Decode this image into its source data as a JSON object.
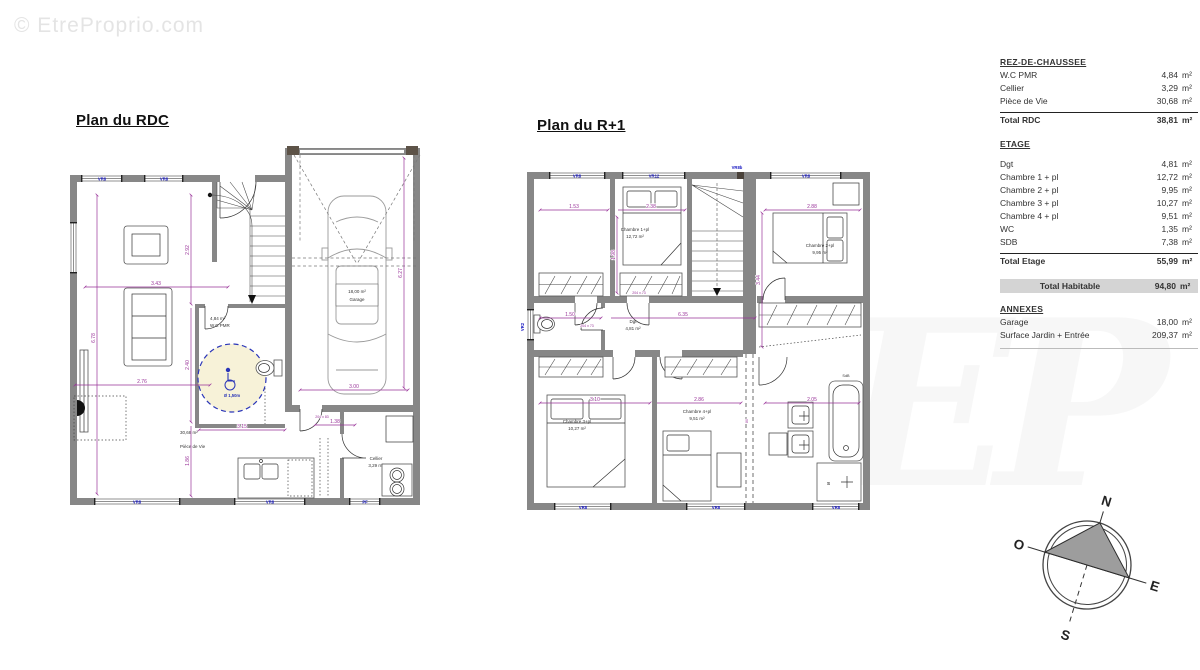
{
  "watermark": {
    "text": "© EtreProprio.com",
    "logo": "EP"
  },
  "plans": {
    "rdc": {
      "title": "Plan du RDC",
      "labels": {
        "wc_area": "4,84 m²",
        "wc_name": "W.C PMR",
        "pmr": "Ø 1,50m",
        "piece_area": "30,68 m²",
        "piece_name": "Pièce de Vie",
        "cellier_name": "Cellier",
        "cellier_area": "3,29 m²",
        "garage_area": "18,00 m²",
        "garage_name": "Garage"
      },
      "dims": {
        "d343": "3.43",
        "d276": "2.76",
        "d292": "2.92",
        "d240": "2.40",
        "d186": "1.86",
        "d678": "6.78",
        "d315": "3.15",
        "d300": "3.00",
        "d627": "6.27",
        "d138": "1.38",
        "door": "204 x 83"
      },
      "windows": {
        "t1": "VR8",
        "t2": "VR8",
        "b1": "VR8",
        "b2": "VR8",
        "b3": "PF"
      }
    },
    "r1": {
      "title": "Plan du R+1",
      "rooms": {
        "ch1_name": "Chambre 1+pl",
        "ch1_area": "12,72 m²",
        "ch2_name": "Chambre 2+pl",
        "ch2_area": "9,95 m²",
        "ch3_name": "Chambre 3+pl",
        "ch3_area": "10,27 m²",
        "ch4_name": "Chambre 4+pl",
        "ch4_area": "9,51 m²",
        "dgt_name": "Dgt",
        "dgt_area": "4,81 m²",
        "sdb_name": "SdB"
      },
      "dims": {
        "d153": "1.53",
        "d238": "2.38",
        "d288": "2.88",
        "d198": "1.98",
        "d344": "3.44",
        "d150": "1.50",
        "d635": "6.35",
        "d310": "3.10",
        "d286": "2.86",
        "d205": "2.05",
        "door": "204 x 73",
        "d80": "80"
      },
      "windows": {
        "t1": "VR8",
        "t2": "VR12",
        "t3": "VR8",
        "t4": "VR8b",
        "b1": "VR8",
        "b2": "VR8",
        "b3": "VR8",
        "l1": "VR2"
      }
    }
  },
  "table": {
    "unit": "m²",
    "rdc": {
      "header": "REZ-DE-CHAUSSEE",
      "rows": [
        {
          "label": "W.C PMR",
          "value": "4,84"
        },
        {
          "label": "Cellier",
          "value": "3,29"
        },
        {
          "label": "Pièce de Vie",
          "value": "30,68"
        }
      ],
      "total_label": "Total RDC",
      "total_value": "38,81"
    },
    "etage": {
      "header": "ETAGE",
      "rows": [
        {
          "label": "Dgt",
          "value": "4,81"
        },
        {
          "label": "Chambre 1 + pl",
          "value": "12,72"
        },
        {
          "label": "Chambre 2 + pl",
          "value": "9,95"
        },
        {
          "label": "Chambre 3 + pl",
          "value": "10,27"
        },
        {
          "label": "Chambre 4 + pl",
          "value": "9,51"
        },
        {
          "label": "WC",
          "value": "1,35"
        },
        {
          "label": "SDB",
          "value": "7,38"
        }
      ],
      "total_label": "Total Etage",
      "total_value": "55,99"
    },
    "habitable": {
      "label": "Total Habitable",
      "value": "94,80"
    },
    "annexes": {
      "header": "ANNEXES",
      "rows": [
        {
          "label": "Garage",
          "value": "18,00"
        },
        {
          "label": "Surface Jardin + Entrée",
          "value": "209,37"
        }
      ]
    }
  },
  "compass": {
    "n": "N",
    "s": "S",
    "e": "E",
    "o": "O"
  }
}
